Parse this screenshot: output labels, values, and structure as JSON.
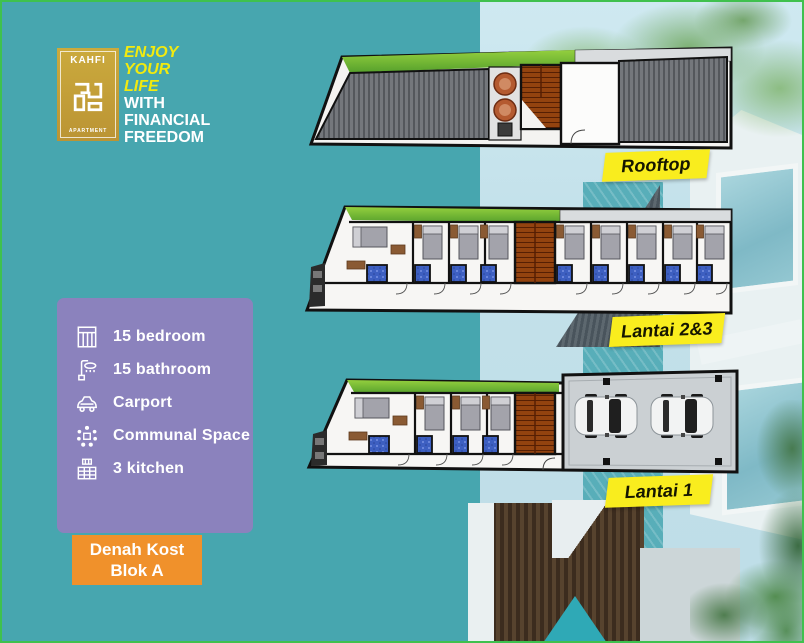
{
  "brand": {
    "logo_title": "KAHFI",
    "logo_subtitle": "APARTMENT"
  },
  "tagline": {
    "highlight_lines": [
      "ENJOY",
      "YOUR",
      "LIFE"
    ],
    "rest_lines": [
      "WITH",
      "FINANCIAL",
      "FREEDOM"
    ]
  },
  "features": {
    "items": [
      {
        "icon": "bed-icon",
        "label": "15 bedroom"
      },
      {
        "icon": "shower-icon",
        "label": "15 bathroom"
      },
      {
        "icon": "car-icon",
        "label": "Carport"
      },
      {
        "icon": "people-icon",
        "label": "Communal Space"
      },
      {
        "icon": "kitchen-icon",
        "label": "3 kitchen"
      }
    ]
  },
  "cta": {
    "line1": "Denah Kost",
    "line2": "Blok A"
  },
  "floors": [
    {
      "id": "rooftop",
      "label": "Rooftop"
    },
    {
      "id": "lantai-2-3",
      "label": "Lantai 2&3"
    },
    {
      "id": "lantai-1",
      "label": "Lantai 1"
    }
  ],
  "colors": {
    "background_teal": "#47A6AF",
    "panel_purple": "#8B82BD",
    "cta_orange": "#F0912B",
    "label_yellow": "#F9ED1E",
    "logo_gold": "#C4A139",
    "tagline_yellow": "#F2EA0F",
    "frame_green": "#3FC14E"
  }
}
